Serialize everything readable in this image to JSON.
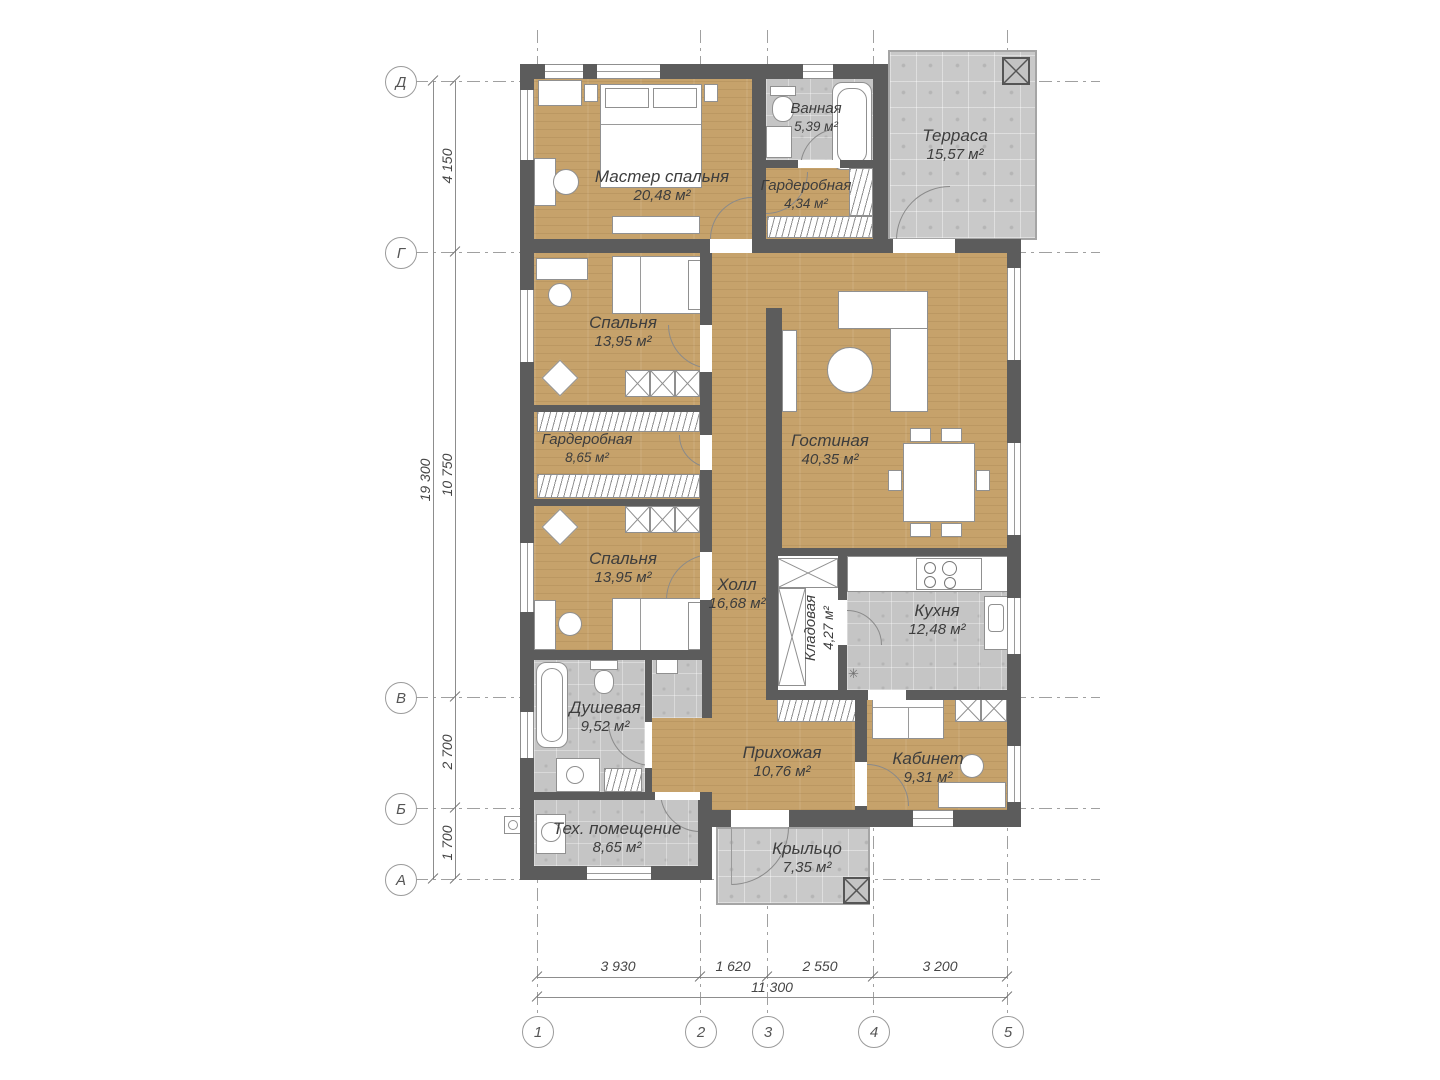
{
  "rooms": [
    {
      "name": "Мастер спальня",
      "area": "20,48 м²"
    },
    {
      "name": "Ванная",
      "area": "5,39 м²"
    },
    {
      "name": "Терраса",
      "area": "15,57 м²"
    },
    {
      "name": "Гардеробная",
      "area": "4,34 м²"
    },
    {
      "name": "Спальня",
      "area": "13,95 м²"
    },
    {
      "name": "Гардеробная",
      "area": "8,65 м²"
    },
    {
      "name": "Гостиная",
      "area": "40,35 м²"
    },
    {
      "name": "Спальня",
      "area": "13,95 м²"
    },
    {
      "name": "Холл",
      "area": "16,68 м²"
    },
    {
      "name": "Кладовая",
      "area": "4,27 м²"
    },
    {
      "name": "Кухня",
      "area": "12,48 м²"
    },
    {
      "name": "Душевая",
      "area": "9,52 м²"
    },
    {
      "name": "Прихожая",
      "area": "10,76 м²"
    },
    {
      "name": "Кабинет",
      "area": "9,31 м²"
    },
    {
      "name": "Тех. помещение",
      "area": "8,65 м²"
    },
    {
      "name": "Крыльцо",
      "area": "7,35 м²"
    }
  ],
  "axes_left": [
    "Д",
    "Г",
    "В",
    "Б",
    "А"
  ],
  "axes_bottom": [
    "1",
    "2",
    "3",
    "4",
    "5"
  ],
  "dims": {
    "left_total": "19 300",
    "left_segments": [
      "4 150",
      "10 750",
      "2 700",
      "1 700"
    ],
    "bottom_segments": [
      "3 930",
      "1 620",
      "2 550",
      "3 200"
    ],
    "bottom_total": "11 300"
  },
  "symbols": {
    "kitchen_marker": "✳"
  },
  "colors": {
    "wood": "#c6a26b",
    "tile": "#c5c5c5",
    "terrace": "#c9c9c9",
    "wall": "#5c5c5c"
  }
}
